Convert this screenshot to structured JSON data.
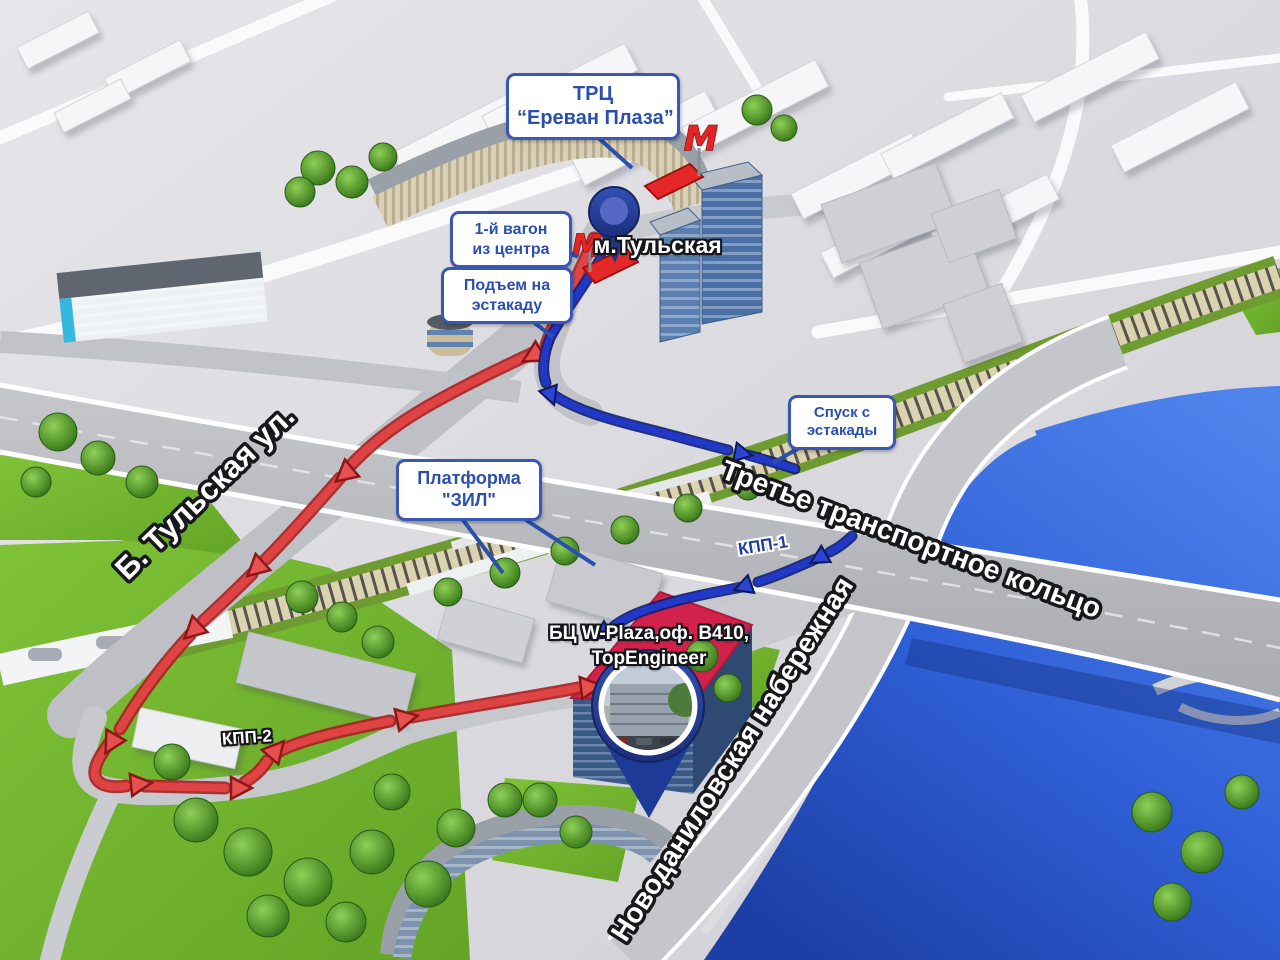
{
  "map": {
    "callouts": {
      "trc": {
        "line1": "ТРЦ",
        "line2": "“Ереван Плаза”"
      },
      "wagon": {
        "line1": "1-й вагон",
        "line2": "из центра"
      },
      "podyom": {
        "line1": "Подъем на",
        "line2": "эстакаду"
      },
      "spusk": {
        "line1": "Спуск с",
        "line2": "эстакады"
      },
      "platform": {
        "line1": "Платформа",
        "line2": "\"ЗИЛ\""
      }
    },
    "labels": {
      "metro_station": "м.Тульская",
      "office_line1": "БЦ W-Plaza,оф. В410,",
      "office_line2": "TopEngineer",
      "checkpoint1": "КПП-1",
      "checkpoint2": "КПП-2"
    },
    "streets": {
      "tulskaya": "Б. Тульская ул.",
      "ttk": "Третье транспортное кольцо",
      "novodanilovskaya": "Новоданиловская набережная"
    },
    "icons": {
      "metro": "М"
    },
    "routes": {
      "car_route_color": "#e04343",
      "walk_route_color": "#2238c8"
    },
    "colors": {
      "callout_border": "#3a57b5",
      "callout_text": "#2b4fae",
      "river": "#3f74e0",
      "lawn": "#74b62f",
      "office_roof": "#d2224c",
      "pin": "#24409c",
      "metro_red": "#e42525"
    }
  }
}
